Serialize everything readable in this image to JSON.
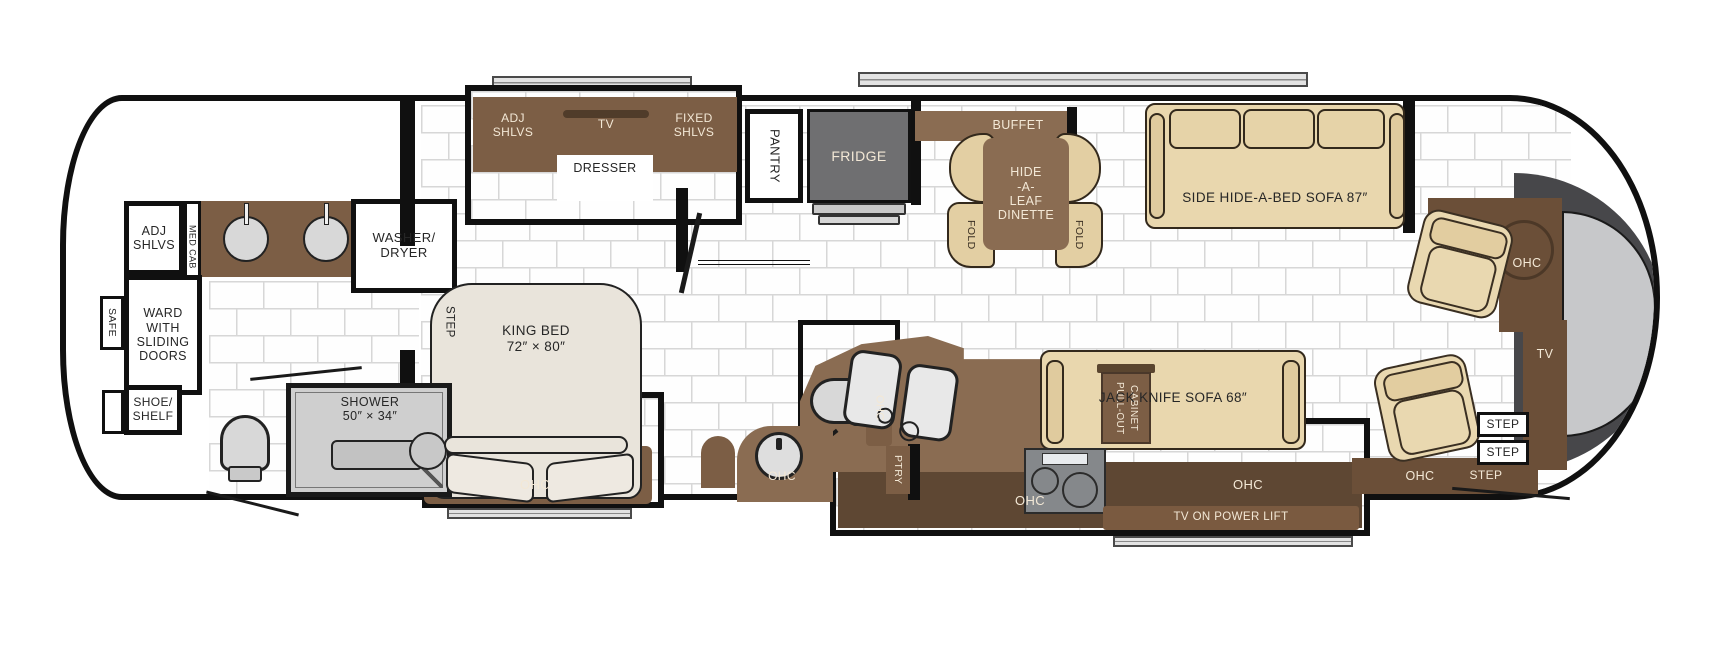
{
  "title": "Class A motorhome floor plan",
  "colors": {
    "wall": "#101010",
    "cabinet_brown": "#7c5e45",
    "counter_brown": "#8a6c52",
    "console_brown": "#6b4f38",
    "band_brown": "#5e4733",
    "tan": "#e9d7ae",
    "fridge_gray": "#6f6f71",
    "dash_gray": "#47474a",
    "windshield_gray": "#c7c8ca",
    "cream_text": "#f3e8d6",
    "tile_line": "#d7d7d7"
  },
  "rear": {
    "safe": "SAFE",
    "adj_shlvs": "ADJ\nSHLVS",
    "med_cab": "MED CAB",
    "washer_dryer": "WASHER/\nDRYER",
    "ward": "WARD\nWITH\nSLIDING\nDOORS",
    "shoe_shelf": "SHOE/\nSHELF",
    "shower": "SHOWER\n50″ × 34″"
  },
  "bedroom": {
    "step": "STEP",
    "adj_shlvs": "ADJ\nSHLVS",
    "tv": "TV",
    "fixed_shlvs": "FIXED\nSHLVS",
    "dresser": "DRESSER",
    "king_bed": "KING BED\n72″ × 80″",
    "ohc": "OHC"
  },
  "galley": {
    "pantry": "PANTRY",
    "fridge": "FRIDGE",
    "buffet": "BUFFET",
    "dinette": "HIDE\n-A-\nLEAF\nDINETTE",
    "fold": "FOLD",
    "ptry": "PTRY",
    "pull_out": "PULL-OUT\nCABINET",
    "ohc": "OHC"
  },
  "bath": {
    "ohc_cabinet": "OHC",
    "vanity_ohc": "OHC"
  },
  "living": {
    "sofa_87": "SIDE HIDE-A-BED SOFA 87″",
    "jack_sofa": "JACK KNIFE SOFA 68″",
    "sofa_ohc": "OHC",
    "tv_lift": "TV ON POWER LIFT"
  },
  "cockpit": {
    "ohc": "OHC",
    "tv": "TV",
    "step": "STEP",
    "ohc_side": "OHC"
  }
}
